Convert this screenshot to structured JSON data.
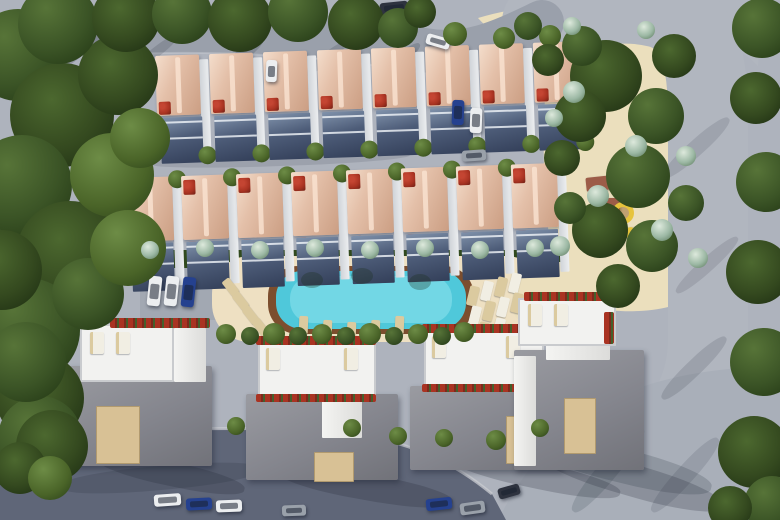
{
  "scene": {
    "description": "Aerial 3D architectural rendering of a residential complex: two rows of townhouses with terracotta hip roofs and red flower planters, a turquoise swimming pool ringed by a brown deck with sun loungers, four large white flat-roofed villas with rooftop terraces, a landscaped park with winding sand paths and a playground, perimeter roads with parked cars, and dense trees along the left and right edges.",
    "summary": {
      "townhouse_rows": 2,
      "townhouses_per_row": 8,
      "villas": 4,
      "pools": 1,
      "playgrounds": 1
    },
    "palette": {
      "ground": "#aeb3bd",
      "roadTop": "#9aa0ab",
      "roadSide": "#b1b6bf",
      "junction": "#a9afb9",
      "roadDark": "#5f6678",
      "curb": "#c9ccd2",
      "parkPath": "#ebdfbd",
      "hedge": "#314a1e",
      "poolDeck": "#eee0c2",
      "poolRim": "#7c4e2e",
      "poolWater": "#4fc8da",
      "poolWaterLight": "#8fe4ee",
      "roofLight": "#f3dcca",
      "roofMid": "#e4c0a9",
      "roofDark": "#cb9e83",
      "wall": "#e9ebed",
      "flower": "#a93322",
      "villaRoof": "#8f9096",
      "villaWhite": "#f2f2f0",
      "villaDeck": "#d8c195",
      "lounger": "#dbca9f",
      "loungerWhite": "#f1eee3",
      "playBase": "#9c5c48",
      "playYellow": "#e6c33c",
      "carWhite": "#eceef0",
      "carBlue": "#25418f",
      "carDark": "#2e333f",
      "carGray": "#9aa1aa"
    },
    "rows": [
      {
        "x": 155,
        "y": 56,
        "rot": -2,
        "sp": 54,
        "count": 8,
        "type": "A"
      },
      {
        "x": 126,
        "y": 178,
        "rot": -2,
        "sp": 55,
        "count": 8,
        "type": "B"
      }
    ],
    "villas": [
      {
        "roof": [
          68,
          366,
          144,
          100
        ],
        "terrace": [
          80,
          324,
          94,
          58
        ],
        "white": [
          [
            174,
            328,
            32,
            54
          ]
        ],
        "planters": [
          [
            110,
            318,
            100,
            10
          ]
        ],
        "deck": [
          96,
          406,
          44,
          58
        ],
        "loungers": [
          [
            90,
            332
          ],
          [
            116,
            332
          ]
        ],
        "shadow": [
          96,
          462,
          150,
          24,
          12
        ]
      },
      {
        "roof": [
          246,
          394,
          152,
          86
        ],
        "terrace": [
          258,
          342,
          118,
          56
        ],
        "white": [
          [
            322,
            398,
            40,
            40
          ]
        ],
        "planters": [
          [
            256,
            336,
            120,
            9
          ],
          [
            256,
            394,
            120,
            8
          ]
        ],
        "deck": [
          314,
          452,
          40,
          30
        ],
        "loungers": [
          [
            266,
            348
          ],
          [
            344,
            348
          ]
        ],
        "shadow": [
          278,
          474,
          176,
          26,
          10
        ]
      },
      {
        "roof": [
          410,
          386,
          152,
          84
        ],
        "terrace": [
          424,
          330,
          120,
          58
        ],
        "white": [
          [
            536,
            392,
            26,
            46
          ]
        ],
        "planters": [
          [
            422,
            324,
            122,
            9
          ],
          [
            422,
            384,
            100,
            8
          ]
        ],
        "deck": [
          506,
          416,
          30,
          48
        ],
        "loungers": [
          [
            432,
            336
          ],
          [
            506,
            336
          ]
        ],
        "shadow": [
          446,
          462,
          176,
          26,
          12
        ]
      },
      {
        "roof": [
          514,
          350,
          130,
          120
        ],
        "terrace": [
          518,
          298,
          98,
          48
        ],
        "white": [
          [
            546,
            334,
            64,
            26
          ],
          [
            514,
            356,
            22,
            110
          ]
        ],
        "planters": [
          [
            524,
            292,
            88,
            9
          ],
          [
            604,
            312,
            10,
            32
          ]
        ],
        "deck": [
          564,
          398,
          32,
          56
        ],
        "loungers": [
          [
            528,
            304
          ],
          [
            554,
            304
          ]
        ],
        "shadow": [
          536,
          464,
          190,
          32,
          16
        ]
      }
    ],
    "pool": {
      "loungersBottom": [
        [
          299,
          316
        ],
        [
          323,
          320
        ],
        [
          347,
          322
        ],
        [
          371,
          320
        ],
        [
          395,
          316
        ]
      ],
      "loungersRight": [
        [
          468,
          286,
          0
        ],
        [
          482,
          281,
          1
        ],
        [
          496,
          277,
          0
        ],
        [
          510,
          273,
          1
        ],
        [
          470,
          306,
          1
        ],
        [
          484,
          301,
          0
        ],
        [
          498,
          297,
          1
        ],
        [
          512,
          293,
          0
        ],
        [
          478,
          322,
          0
        ],
        [
          494,
          318,
          1
        ]
      ],
      "loungersLeft": [
        [
          226,
          278
        ],
        [
          236,
          292
        ],
        [
          246,
          306
        ],
        [
          256,
          318
        ]
      ],
      "umbrellaShadows": [
        [
          312,
          280
        ],
        [
          362,
          276
        ],
        [
          420,
          282
        ]
      ]
    },
    "playground": {
      "pieces": [
        [
          586,
          176,
          36,
          14,
          "base",
          -6
        ],
        [
          618,
          178,
          16,
          9,
          "slide",
          20
        ],
        [
          590,
          198,
          30,
          26,
          "base",
          0
        ],
        [
          588,
          230,
          36,
          13,
          "base",
          4
        ],
        [
          620,
          228,
          15,
          9,
          "slide",
          -15
        ]
      ],
      "spiral": [
        612,
        202
      ]
    },
    "cars": [
      [
        380,
        2,
        28,
        12,
        "carDark",
        -6
      ],
      [
        426,
        36,
        24,
        11,
        "carWhite",
        16
      ],
      [
        452,
        100,
        12,
        25,
        "carBlue",
        2
      ],
      [
        470,
        108,
        12,
        25,
        "carWhite",
        2
      ],
      [
        462,
        150,
        24,
        11,
        "carGray",
        -4
      ],
      [
        266,
        60,
        11,
        22,
        "carWhite",
        2
      ],
      [
        148,
        276,
        13,
        30,
        "carWhite",
        6
      ],
      [
        165,
        276,
        13,
        30,
        "carWhite",
        6
      ],
      [
        182,
        277,
        13,
        30,
        "carBlue",
        6
      ],
      [
        154,
        494,
        27,
        12,
        "carWhite",
        -4
      ],
      [
        186,
        498,
        26,
        12,
        "carBlue",
        -3
      ],
      [
        216,
        500,
        26,
        12,
        "carWhite",
        -2
      ],
      [
        282,
        505,
        24,
        11,
        "carGray",
        -2
      ],
      [
        426,
        498,
        26,
        12,
        "carBlue",
        -6
      ],
      [
        460,
        502,
        25,
        12,
        "carGray",
        -8
      ],
      [
        498,
        486,
        22,
        11,
        "carDark",
        -16
      ]
    ],
    "shadows": [
      [
        70,
        22,
        12,
        62,
        52,
        0.2
      ],
      [
        150,
        24,
        10,
        58,
        52,
        0.16
      ],
      [
        235,
        28,
        12,
        56,
        52,
        0.18
      ],
      [
        320,
        32,
        10,
        54,
        52,
        0.16
      ],
      [
        392,
        34,
        12,
        56,
        50,
        0.18
      ],
      [
        688,
        104,
        16,
        88,
        48,
        0.13
      ],
      [
        700,
        224,
        14,
        82,
        48,
        0.12
      ],
      [
        686,
        324,
        16,
        88,
        46,
        0.14
      ],
      [
        598,
        416,
        20,
        108,
        40,
        0.15
      ],
      [
        676,
        426,
        18,
        98,
        42,
        0.13
      ],
      [
        60,
        466,
        200,
        24,
        -5,
        0.16
      ],
      [
        524,
        448,
        190,
        34,
        14,
        0.18
      ],
      [
        150,
        152,
        260,
        14,
        -2,
        0.12
      ]
    ],
    "trees": [
      [
        18,
        55,
        46,
        "1"
      ],
      [
        62,
        115,
        52,
        "2"
      ],
      [
        22,
        185,
        50,
        "1"
      ],
      [
        70,
        255,
        54,
        "2"
      ],
      [
        28,
        330,
        52,
        "1"
      ],
      [
        40,
        398,
        44,
        "2"
      ],
      [
        112,
        175,
        42,
        "3"
      ],
      [
        88,
        294,
        36,
        "1"
      ],
      [
        118,
        75,
        40,
        "2"
      ],
      [
        128,
        248,
        38,
        "3"
      ],
      [
        40,
        438,
        42,
        "1"
      ],
      [
        52,
        446,
        36,
        "2"
      ],
      [
        26,
        362,
        40,
        "1"
      ],
      [
        58,
        24,
        40,
        "1"
      ],
      [
        126,
        18,
        34,
        "2"
      ],
      [
        2,
        270,
        40,
        "2"
      ],
      [
        140,
        138,
        30,
        "3"
      ],
      [
        20,
        468,
        26,
        "2"
      ],
      [
        50,
        478,
        22,
        "3"
      ],
      [
        182,
        14,
        30,
        "1"
      ],
      [
        240,
        20,
        32,
        "2"
      ],
      [
        298,
        12,
        30,
        "1"
      ],
      [
        356,
        22,
        28,
        "2"
      ],
      [
        398,
        28,
        20,
        "1"
      ],
      [
        420,
        12,
        16,
        "2"
      ],
      [
        455,
        34,
        12,
        "3"
      ],
      [
        504,
        38,
        11,
        "3"
      ],
      [
        550,
        36,
        11,
        "3"
      ],
      [
        762,
        28,
        30,
        "1"
      ],
      [
        756,
        98,
        26,
        "2"
      ],
      [
        766,
        182,
        30,
        "1"
      ],
      [
        758,
        272,
        32,
        "2"
      ],
      [
        764,
        362,
        34,
        "1"
      ],
      [
        754,
        452,
        36,
        "2"
      ],
      [
        772,
        504,
        28,
        "1"
      ],
      [
        730,
        508,
        22,
        "2"
      ],
      [
        606,
        76,
        36,
        "2"
      ],
      [
        656,
        116,
        28,
        "1"
      ],
      [
        580,
        116,
        26,
        "2"
      ],
      [
        638,
        176,
        32,
        "1"
      ],
      [
        600,
        230,
        28,
        "2"
      ],
      [
        652,
        246,
        26,
        "1"
      ],
      [
        618,
        286,
        22,
        "2"
      ],
      [
        582,
        46,
        20,
        "1"
      ],
      [
        674,
        56,
        22,
        "2"
      ],
      [
        686,
        203,
        18,
        "1"
      ],
      [
        562,
        158,
        18,
        "2"
      ],
      [
        570,
        208,
        16,
        "1"
      ],
      [
        548,
        60,
        16,
        "2"
      ],
      [
        528,
        26,
        14,
        "1"
      ],
      [
        574,
        92,
        11,
        "b"
      ],
      [
        636,
        146,
        11,
        "b"
      ],
      [
        598,
        196,
        11,
        "b"
      ],
      [
        662,
        230,
        11,
        "b"
      ],
      [
        560,
        246,
        10,
        "b"
      ],
      [
        686,
        156,
        10,
        "b"
      ],
      [
        572,
        26,
        9,
        "b"
      ],
      [
        646,
        30,
        9,
        "b"
      ],
      [
        698,
        258,
        10,
        "b"
      ],
      [
        554,
        118,
        9,
        "b"
      ],
      [
        150,
        250,
        9,
        "b"
      ],
      [
        205,
        248,
        9,
        "b"
      ],
      [
        260,
        250,
        9,
        "b"
      ],
      [
        315,
        248,
        9,
        "b"
      ],
      [
        370,
        250,
        9,
        "b"
      ],
      [
        425,
        248,
        9,
        "b"
      ],
      [
        480,
        250,
        9,
        "b"
      ],
      [
        535,
        248,
        9,
        "b"
      ],
      [
        236,
        426,
        9,
        "3"
      ],
      [
        352,
        428,
        9,
        "3"
      ],
      [
        398,
        436,
        9,
        "3"
      ],
      [
        444,
        438,
        9,
        "3"
      ],
      [
        496,
        440,
        10,
        "3"
      ],
      [
        540,
        428,
        9,
        "3"
      ],
      [
        226,
        334,
        10,
        "3"
      ],
      [
        250,
        336,
        9,
        "1"
      ],
      [
        274,
        334,
        11,
        "3"
      ],
      [
        298,
        336,
        9,
        "1"
      ],
      [
        322,
        334,
        10,
        "3"
      ],
      [
        346,
        336,
        9,
        "1"
      ],
      [
        370,
        334,
        11,
        "3"
      ],
      [
        394,
        336,
        9,
        "1"
      ],
      [
        418,
        334,
        10,
        "3"
      ],
      [
        442,
        336,
        9,
        "1"
      ],
      [
        464,
        332,
        10,
        "3"
      ]
    ]
  }
}
